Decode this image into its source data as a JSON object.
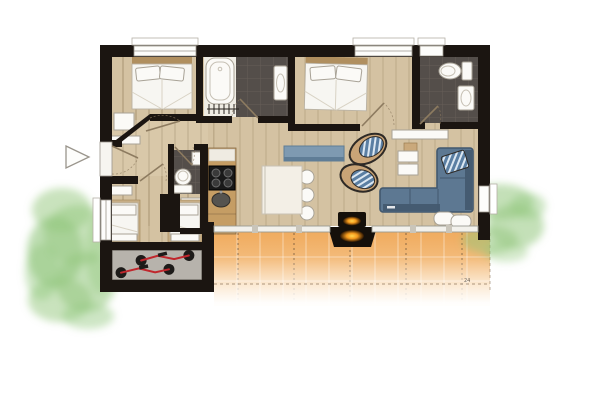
{
  "meta": {
    "title": "apartment-floor-plan",
    "description": "Top-down rendered architectural floor plan with terrace and garden"
  },
  "colors": {
    "wall": "#1b1511",
    "floor_wood": "#d4c2a2",
    "hall_wood": "#e2d5b8",
    "counter_wood": "#c59d64",
    "tile_dark": "#544e4a",
    "tile_grid": "#665e58",
    "fixture_white": "#fbfaf7",
    "fixture_stroke": "#a8a296",
    "terrace": "#f2b167",
    "terrace_dash": "#6d5236",
    "grass": "#93c77e",
    "sofa": "#5d7892",
    "sofa_dark": "#42586e",
    "chair_blue": "#5b7fa3",
    "bench_blue": "#7e9ab1",
    "cushion_tan": "#c9a477",
    "fire_glow": "#f9a825",
    "fire_body": "#15100a",
    "bike_red": "#c0272d",
    "storage_floor": "#b7b3ac",
    "bed_white": "#f7f6f2",
    "wood_frame": "#b08f5f",
    "door_arc": "#8d7b60"
  },
  "annotations": {
    "deck_mark": "24"
  },
  "rooms": [
    {
      "id": "bedroom-master",
      "objects": [
        "double-bed",
        "chest",
        "sideboard"
      ]
    },
    {
      "id": "bathroom-main",
      "objects": [
        "bathtub",
        "washbasin",
        "towel-radiator"
      ]
    },
    {
      "id": "bedroom-second",
      "objects": [
        "double-bed"
      ]
    },
    {
      "id": "bathroom-ensuite",
      "objects": [
        "toilet",
        "washbasin"
      ]
    },
    {
      "id": "wc",
      "objects": [
        "toilet",
        "washbasin",
        "washing-machine"
      ]
    },
    {
      "id": "kids-bedroom",
      "objects": [
        "single-bed",
        "single-bed",
        "shelf"
      ]
    },
    {
      "id": "storage-room",
      "objects": [
        "bicycle",
        "bicycle"
      ]
    },
    {
      "id": "kitchen",
      "objects": [
        "counter",
        "cooktop",
        "sink"
      ]
    },
    {
      "id": "dining-area",
      "objects": [
        "dining-table",
        "chair",
        "chair",
        "chair"
      ]
    },
    {
      "id": "living-room",
      "objects": [
        "sectional-sofa",
        "armchair",
        "armchair",
        "coffee-table",
        "media-sideboard",
        "blue-bench",
        "side-table",
        "pouf",
        "pouf",
        "fireplace"
      ]
    },
    {
      "id": "terrace",
      "objects": [
        "wood-decking",
        "outdoor-fireplace",
        "dimension-mark"
      ]
    },
    {
      "id": "garden",
      "objects": [
        "lawn-left",
        "lawn-right"
      ]
    },
    {
      "id": "entrance",
      "objects": [
        "entry-door",
        "entry-direction-arrow"
      ]
    }
  ]
}
